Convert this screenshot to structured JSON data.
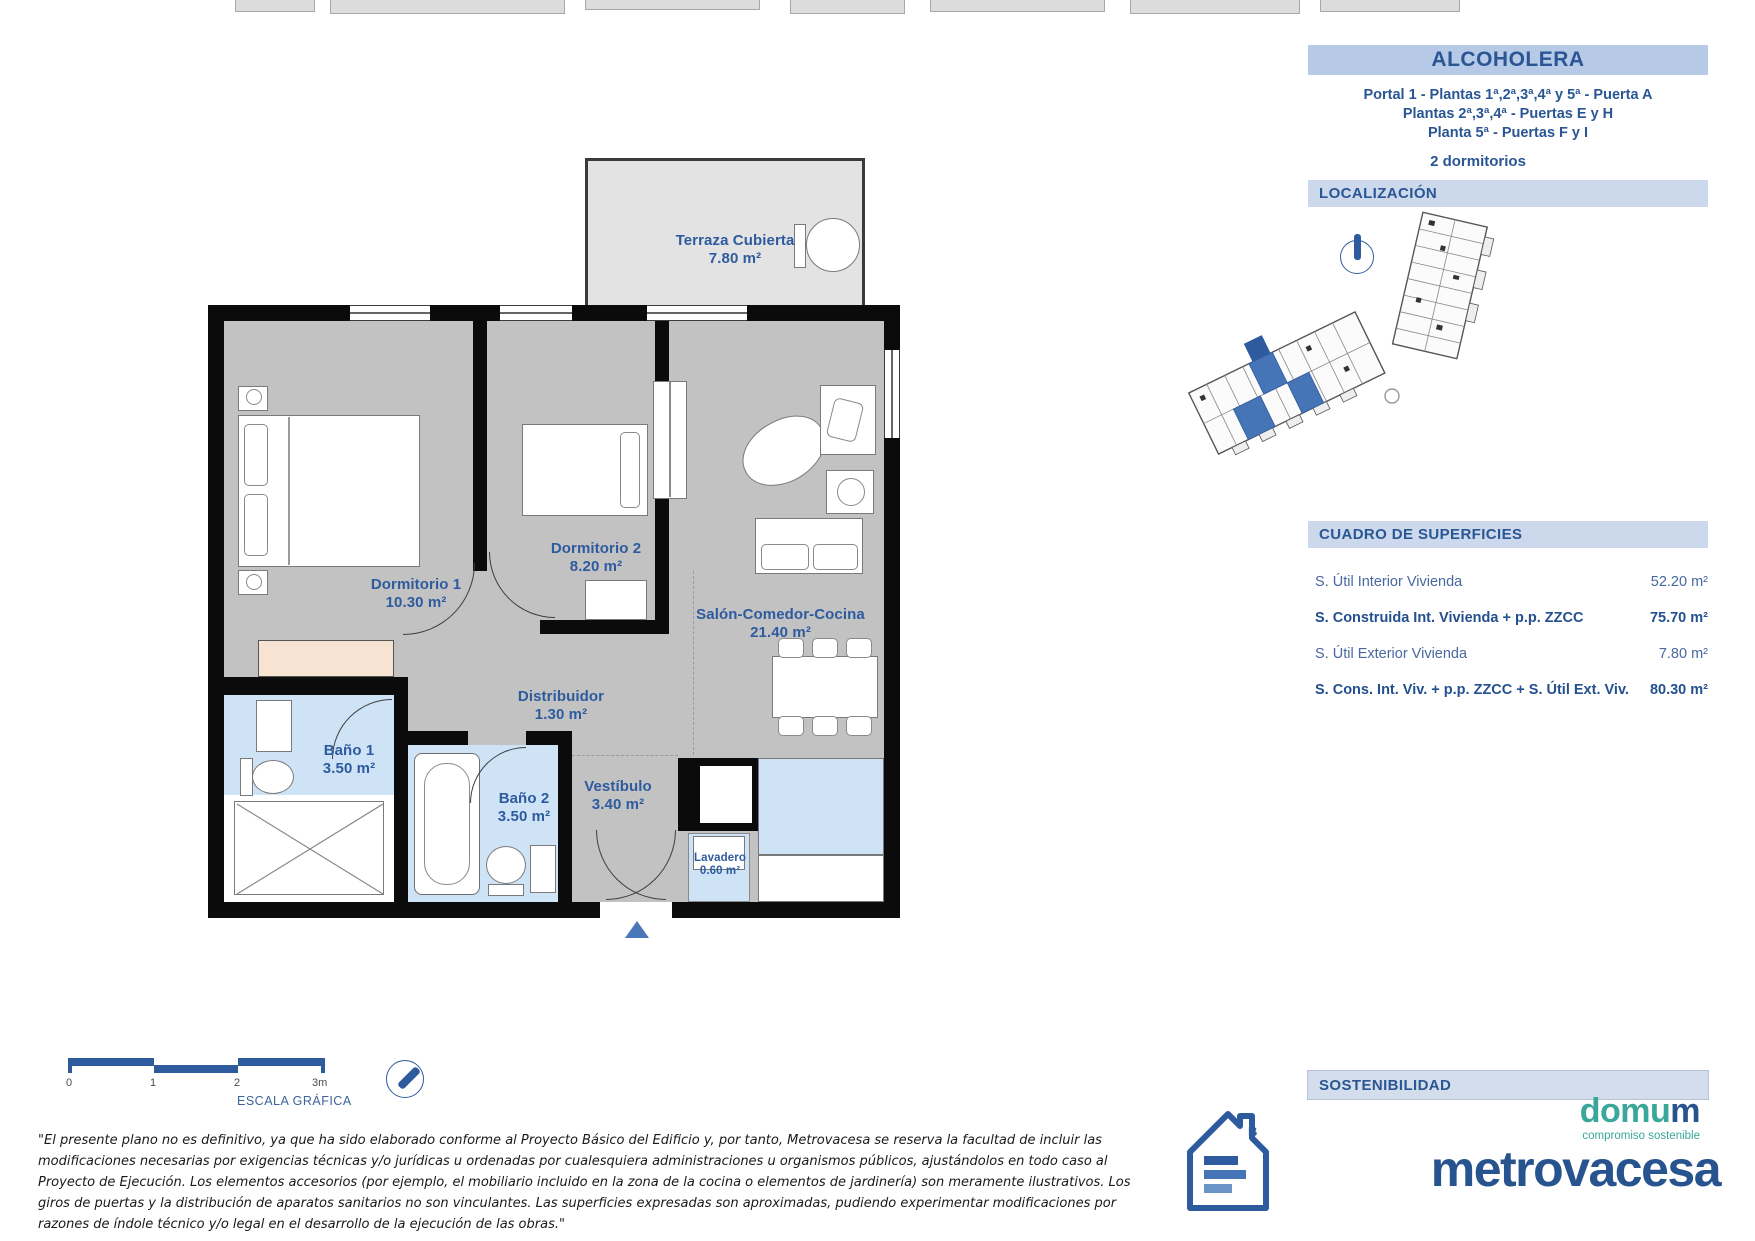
{
  "page": {
    "title": "ALCOHOLERA"
  },
  "header": {
    "portal_line1": "Portal 1 - Plantas 1ª,2ª,3ª,4ª y 5ª - Puerta  A",
    "portal_line2": "Plantas 2ª,3ª,4ª - Puertas E y H",
    "portal_line3": "Planta 5ª - Puertas F y I",
    "bedrooms": "2 dormitorios"
  },
  "sections": {
    "localizacion": "LOCALIZACIÓN",
    "cuadro": "CUADRO DE SUPERFICIES",
    "sostenibilidad": "SOSTENIBILIDAD"
  },
  "surfaces": {
    "rows": [
      {
        "label": "S. Útil Interior Vivienda",
        "value": "52.20 m²"
      },
      {
        "label": "S. Construida Int. Vivienda + p.p. ZZCC",
        "value": "75.70 m²"
      },
      {
        "label": "S. Útil Exterior Vivienda",
        "value": "7.80 m²"
      },
      {
        "label": "S. Cons. Int. Viv. + p.p. ZZCC + S. Útil Ext. Viv.",
        "value": "80.30 m²"
      }
    ]
  },
  "rooms": {
    "terraza": {
      "name": "Terraza Cubierta",
      "area": "7.80 m²"
    },
    "dormitorio1": {
      "name": "Dormitorio 1",
      "area": "10.30 m²"
    },
    "dormitorio2": {
      "name": "Dormitorio 2",
      "area": "8.20 m²"
    },
    "salon": {
      "name": "Salón-Comedor-Cocina",
      "area": "21.40 m²"
    },
    "distribuidor": {
      "name": "Distribuidor",
      "area": "1.30 m²"
    },
    "bano1": {
      "name": "Baño 1",
      "area": "3.50 m²"
    },
    "bano2": {
      "name": "Baño 2",
      "area": "3.50 m²"
    },
    "vestibulo": {
      "name": "Vestíbulo",
      "area": "3.40 m²"
    },
    "lavadero": {
      "name": "Lavadero",
      "area": "0.60 m²"
    }
  },
  "scale": {
    "ticks": [
      "0",
      "1",
      "2",
      "3m"
    ],
    "label": "ESCALA GRÁFICA"
  },
  "disclaimer": "\"El presente plano no es definitivo, ya que ha sido elaborado conforme al Proyecto Básico del Edificio y, por tanto, Metrovacesa se reserva la facultad de incluir las modificaciones  necesarias por exigencias  técnicas y/o jurídicas u ordenadas por cualesquiera administraciones u organismos públicos, ajustándolos en todo caso al Proyecto de Ejecución. Los elementos accesorios (por ejemplo, el mobiliario incluido en la zona  de la cocina o elementos de jardinería) son meramente ilustrativos. Los giros de puertas y la distribución de aparatos sanitarios no son vinculantes. Las superficies expresadas son aproximadas, pudiendo experimentar modificaciones por razones de índole técnico y/o legal en el desarrollo de la ejecución de las obras.\"",
  "logos": {
    "domum_prefix": "domu",
    "domum_suffix": "m",
    "domum_tagline": "compromiso sostenible",
    "metrovacesa": "metrovacesa",
    "energy_rating": "B"
  },
  "colors": {
    "accent_blue": "#2e5b9e",
    "bar_header_bg": "#b6c9e6",
    "bar_section_bg": "#ccd8eb",
    "bath_blue": "#cfe3f7",
    "floor_gray": "#c2c2c3",
    "terrace_gray": "#e3e3e3",
    "wardrobe_beige": "#f6e3d2",
    "teal": "#3aa79b"
  }
}
